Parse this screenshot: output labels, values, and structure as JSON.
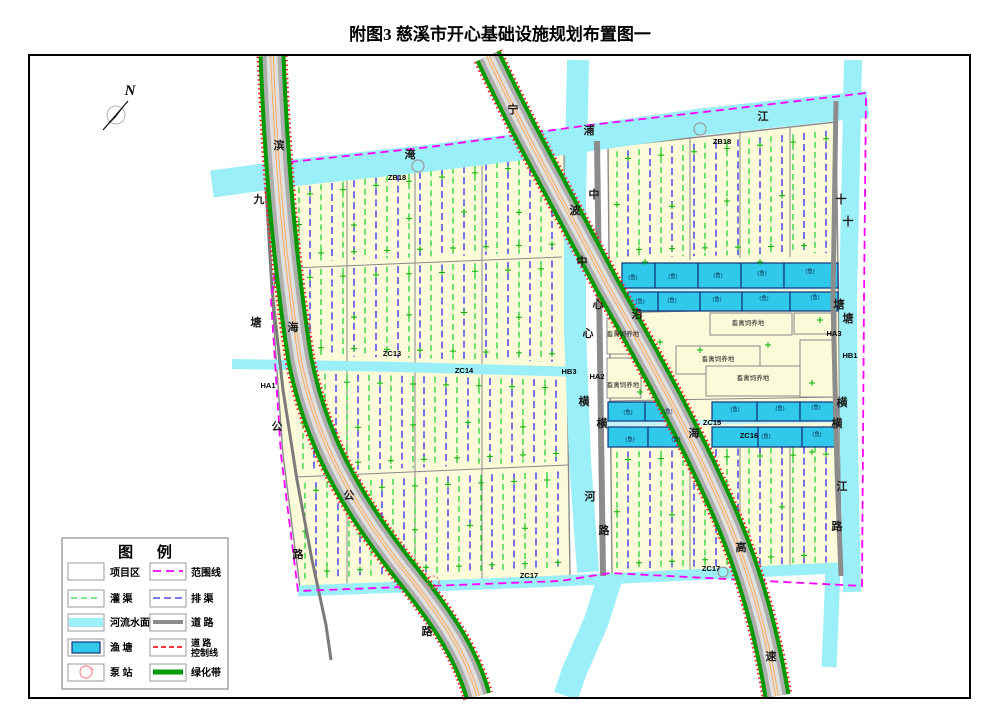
{
  "title": "附图3  慈溪市开心基础设施规划布置图一",
  "compass": {
    "label": "N"
  },
  "colors": {
    "area": "#FBFBD9",
    "river": "#9BEFF8",
    "pond": "#30C8EB",
    "irrigation_green": "#00CC22",
    "drain_blue": "#2B2BE8",
    "boundary_magenta": "#FF00FF",
    "road_gray": "#ADADAD",
    "green_belt": "#009900",
    "control_red": "#FF1A1A",
    "center_orange": "#FFA64D",
    "divider_gray": "#8A8A8A",
    "pump_pink": "#FF8A8A"
  },
  "legend": {
    "title": "图  例",
    "items": [
      {
        "label": "项目区",
        "swatch": "project-area-fill"
      },
      {
        "label": "灌  渠",
        "swatch": "green-dashed-line"
      },
      {
        "label": "河流水面",
        "swatch": "river-water-fill"
      },
      {
        "label": "渔  塘",
        "swatch": "fish-pond-fill"
      },
      {
        "label": "泵  站",
        "swatch": "pump-station-circle"
      },
      {
        "label": "范围线",
        "swatch": "magenta-dashed-line"
      },
      {
        "label": "排  渠",
        "swatch": "blue-dashed-line"
      },
      {
        "label": "道  路",
        "swatch": "gray-road-line"
      },
      {
        "label": "道  路",
        "label2": "控制线",
        "swatch": "red-dashed-line"
      },
      {
        "label": "绿化带",
        "swatch": "green-belt-line"
      }
    ]
  },
  "map": {
    "road_names": {
      "binhai_highway": "滨海公路",
      "jiutang_highway": "九塘公路",
      "ningbo_coastal_expressway": "宁波沿海高速",
      "central_road": "中心横路",
      "central_river": "中心横河",
      "yanpu_river": "淹浦江",
      "shitang_river": "十塘横江"
    },
    "labels": [
      {
        "t": "滨",
        "x": 279,
        "y": 149,
        "k": "ch",
        "n": "binhai-road-label"
      },
      {
        "t": "海",
        "x": 293,
        "y": 331,
        "k": "ch",
        "n": "binhai-road-label"
      },
      {
        "t": "公",
        "x": 349,
        "y": 499,
        "k": "ch",
        "n": "binhai-road-label"
      },
      {
        "t": "路",
        "x": 427,
        "y": 635,
        "k": "ch",
        "n": "binhai-road-label"
      },
      {
        "t": "九",
        "x": 259,
        "y": 203,
        "k": "ch",
        "n": "jiutang-road-label"
      },
      {
        "t": "塘",
        "x": 256,
        "y": 326,
        "k": "ch",
        "n": "jiutang-road-label"
      },
      {
        "t": "公",
        "x": 277,
        "y": 430,
        "k": "ch",
        "n": "jiutang-road-label"
      },
      {
        "t": "路",
        "x": 298,
        "y": 558,
        "k": "ch",
        "n": "jiutang-road-label"
      },
      {
        "t": "宁",
        "x": 513,
        "y": 113,
        "k": "ch",
        "n": "expressway-label"
      },
      {
        "t": "波",
        "x": 575,
        "y": 214,
        "k": "ch",
        "n": "expressway-label"
      },
      {
        "t": "沿",
        "x": 637,
        "y": 318,
        "k": "ch",
        "n": "expressway-label"
      },
      {
        "t": "海",
        "x": 694,
        "y": 437,
        "k": "ch",
        "n": "expressway-label"
      },
      {
        "t": "高",
        "x": 741,
        "y": 551,
        "k": "ch",
        "n": "expressway-label"
      },
      {
        "t": "速",
        "x": 771,
        "y": 660,
        "k": "ch",
        "n": "expressway-label"
      },
      {
        "t": "中",
        "x": 594,
        "y": 198,
        "k": "ch",
        "n": "central-road-label"
      },
      {
        "t": "心",
        "x": 598,
        "y": 308,
        "k": "ch",
        "n": "central-road-label"
      },
      {
        "t": "横",
        "x": 602,
        "y": 427,
        "k": "ch",
        "n": "central-road-label"
      },
      {
        "t": "路",
        "x": 604,
        "y": 534,
        "k": "ch",
        "n": "central-road-label"
      },
      {
        "t": "中",
        "x": 582,
        "y": 265,
        "k": "ch",
        "n": "central-river-label"
      },
      {
        "t": "心",
        "x": 588,
        "y": 337,
        "k": "ch",
        "n": "central-river-label"
      },
      {
        "t": "横",
        "x": 584,
        "y": 405,
        "k": "ch",
        "n": "central-river-label"
      },
      {
        "t": "河",
        "x": 590,
        "y": 500,
        "k": "ch",
        "n": "central-river-label"
      },
      {
        "t": "淹",
        "x": 410,
        "y": 158,
        "k": "ch",
        "n": "yanpu-river-label"
      },
      {
        "t": "浦",
        "x": 589,
        "y": 134,
        "k": "ch",
        "n": "yanpu-river-label"
      },
      {
        "t": "江",
        "x": 763,
        "y": 120,
        "k": "ch",
        "n": "yanpu-river-label"
      },
      {
        "t": "十",
        "x": 841,
        "y": 203,
        "k": "ch",
        "n": "shitang-river-label"
      },
      {
        "t": "塘",
        "x": 839,
        "y": 308,
        "k": "ch",
        "n": "shitang-river-label"
      },
      {
        "t": "横",
        "x": 842,
        "y": 406,
        "k": "ch",
        "n": "shitang-river-label"
      },
      {
        "t": "江",
        "x": 842,
        "y": 490,
        "k": "ch",
        "n": "shitang-river-label"
      },
      {
        "t": "十",
        "x": 848,
        "y": 225,
        "k": "ch",
        "n": "east-road-label"
      },
      {
        "t": "塘",
        "x": 848,
        "y": 322,
        "k": "ch",
        "n": "east-road-label"
      },
      {
        "t": "横",
        "x": 837,
        "y": 427,
        "k": "ch",
        "n": "east-road-label"
      },
      {
        "t": "路",
        "x": 837,
        "y": 530,
        "k": "ch",
        "n": "east-road-label"
      },
      {
        "t": "ZB18",
        "x": 397,
        "y": 180,
        "k": "cd",
        "n": "pump-station-code"
      },
      {
        "t": "ZB18",
        "x": 722,
        "y": 144,
        "k": "cd",
        "n": "pump-station-code"
      },
      {
        "t": "ZC13",
        "x": 392,
        "y": 356,
        "k": "cd",
        "n": "canal-code"
      },
      {
        "t": "ZC14",
        "x": 464,
        "y": 373,
        "k": "cd",
        "n": "canal-code"
      },
      {
        "t": "ZC15",
        "x": 712,
        "y": 425,
        "k": "cd",
        "n": "canal-code"
      },
      {
        "t": "ZC16",
        "x": 749,
        "y": 438,
        "k": "cd",
        "n": "canal-code"
      },
      {
        "t": "ZC17",
        "x": 529,
        "y": 578,
        "k": "cd",
        "n": "canal-code"
      },
      {
        "t": "ZC17",
        "x": 711,
        "y": 571,
        "k": "cd",
        "n": "canal-code"
      },
      {
        "t": "HA1",
        "x": 268,
        "y": 388,
        "k": "cd",
        "n": "node-code"
      },
      {
        "t": "HA2",
        "x": 597,
        "y": 379,
        "k": "cd",
        "n": "node-code"
      },
      {
        "t": "HB3",
        "x": 569,
        "y": 374,
        "k": "cd",
        "n": "node-code"
      },
      {
        "t": "HA3",
        "x": 834,
        "y": 336,
        "k": "cd",
        "n": "node-code"
      },
      {
        "t": "HB1",
        "x": 850,
        "y": 358,
        "k": "cd",
        "n": "node-code"
      },
      {
        "t": "畜禽饲养地",
        "x": 623,
        "y": 336,
        "k": "lv",
        "n": "livestock-area-label"
      },
      {
        "t": "畜禽饲养地",
        "x": 623,
        "y": 387,
        "k": "lv",
        "n": "livestock-area-label"
      },
      {
        "t": "畜禽饲养地",
        "x": 748,
        "y": 325,
        "k": "lv",
        "n": "livestock-area-label"
      },
      {
        "t": "畜禽饲养地",
        "x": 718,
        "y": 361,
        "k": "lv",
        "n": "livestock-area-label"
      },
      {
        "t": "畜禽饲养地",
        "x": 753,
        "y": 380,
        "k": "lv",
        "n": "livestock-area-label"
      },
      {
        "t": "(鱼)",
        "x": 633,
        "y": 279,
        "k": "fs",
        "n": "fishpond-label"
      },
      {
        "t": "(鱼)",
        "x": 673,
        "y": 278,
        "k": "fs",
        "n": "fishpond-label"
      },
      {
        "t": "(鱼)",
        "x": 718,
        "y": 277,
        "k": "fs",
        "n": "fishpond-label"
      },
      {
        "t": "(鱼)",
        "x": 762,
        "y": 275,
        "k": "fs",
        "n": "fishpond-label"
      },
      {
        "t": "(鱼)",
        "x": 810,
        "y": 273,
        "k": "fs",
        "n": "fishpond-label"
      },
      {
        "t": "(鱼)",
        "x": 640,
        "y": 303,
        "k": "fs",
        "n": "fishpond-label"
      },
      {
        "t": "(鱼)",
        "x": 672,
        "y": 302,
        "k": "fs",
        "n": "fishpond-label"
      },
      {
        "t": "(鱼)",
        "x": 717,
        "y": 301,
        "k": "fs",
        "n": "fishpond-label"
      },
      {
        "t": "(鱼)",
        "x": 764,
        "y": 300,
        "k": "fs",
        "n": "fishpond-label"
      },
      {
        "t": "(鱼)",
        "x": 815,
        "y": 299,
        "k": "fs",
        "n": "fishpond-label"
      },
      {
        "t": "(鱼)",
        "x": 628,
        "y": 414,
        "k": "fs",
        "n": "fishpond-label"
      },
      {
        "t": "(鱼)",
        "x": 668,
        "y": 413,
        "k": "fs",
        "n": "fishpond-label"
      },
      {
        "t": "(鱼)",
        "x": 735,
        "y": 411,
        "k": "fs",
        "n": "fishpond-label"
      },
      {
        "t": "(鱼)",
        "x": 780,
        "y": 410,
        "k": "fs",
        "n": "fishpond-label"
      },
      {
        "t": "(鱼)",
        "x": 816,
        "y": 409,
        "k": "fs",
        "n": "fishpond-label"
      },
      {
        "t": "(鱼)",
        "x": 630,
        "y": 441,
        "k": "fs",
        "n": "fishpond-label"
      },
      {
        "t": "(鱼)",
        "x": 676,
        "y": 441,
        "k": "fs",
        "n": "fishpond-label"
      },
      {
        "t": "(鱼)",
        "x": 766,
        "y": 438,
        "k": "fs",
        "n": "fishpond-label"
      },
      {
        "t": "(鱼)",
        "x": 817,
        "y": 436,
        "k": "fs",
        "n": "fishpond-label"
      }
    ]
  }
}
